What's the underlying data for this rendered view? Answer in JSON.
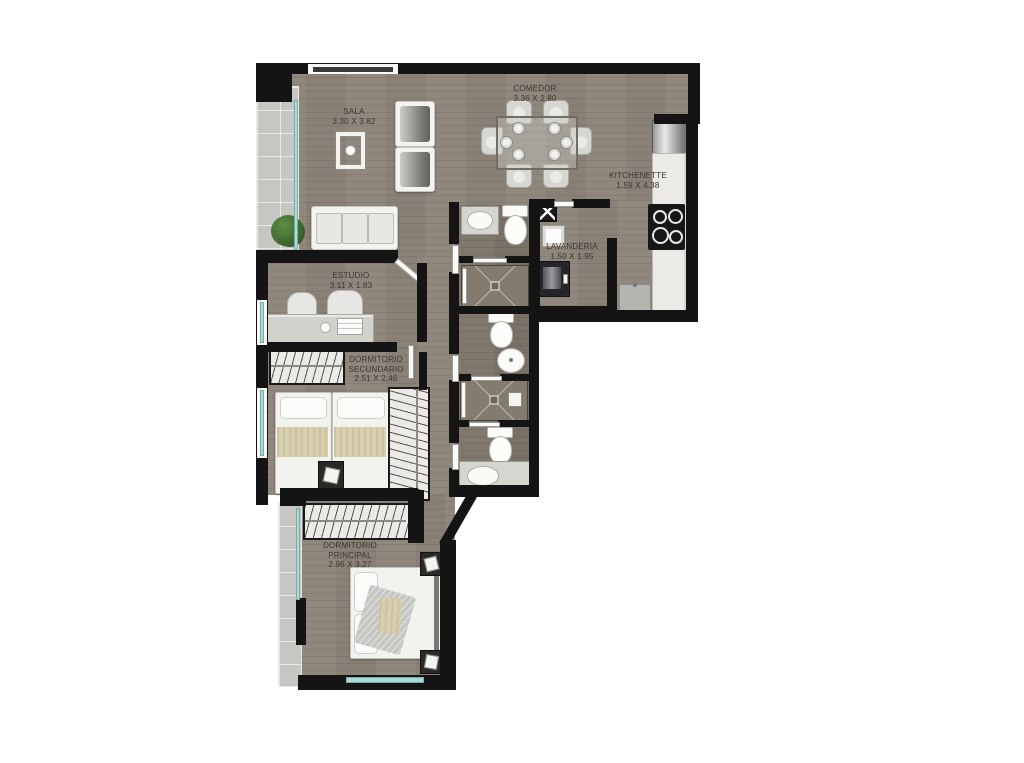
{
  "plan": {
    "rooms": {
      "sala": {
        "lines": [
          "SALA",
          "3.30 X 3.82"
        ]
      },
      "comedor": {
        "lines": [
          "COMEDOR",
          "3.36 X 2.80"
        ]
      },
      "kitchenette": {
        "lines": [
          "KITCHENETTE",
          "1.59 X 4.38"
        ]
      },
      "lavanderia": {
        "lines": [
          "LAVANDERIA",
          "1.50 X 1.95"
        ]
      },
      "estudio": {
        "lines": [
          "ESTUDIO",
          "3.11 X 1.83"
        ]
      },
      "dormitorio_secundario": {
        "lines": [
          "DORMITORIO",
          "SECUNDARIO",
          "2.51 X 2.46"
        ]
      },
      "dormitorio_principal": {
        "lines": [
          "DORMITORIO",
          "PRINCIPAL",
          "2.96 X 3.27"
        ]
      }
    },
    "colors": {
      "wall": "#141414",
      "floor_wood": "#8d8479",
      "floor_bath": "#7c7368",
      "balcony_tile": "#c6c6c3",
      "window_glass": "#a9dcd8",
      "counter": "#eceae7",
      "label_text": "#3a362f",
      "background": "#ffffff"
    }
  }
}
